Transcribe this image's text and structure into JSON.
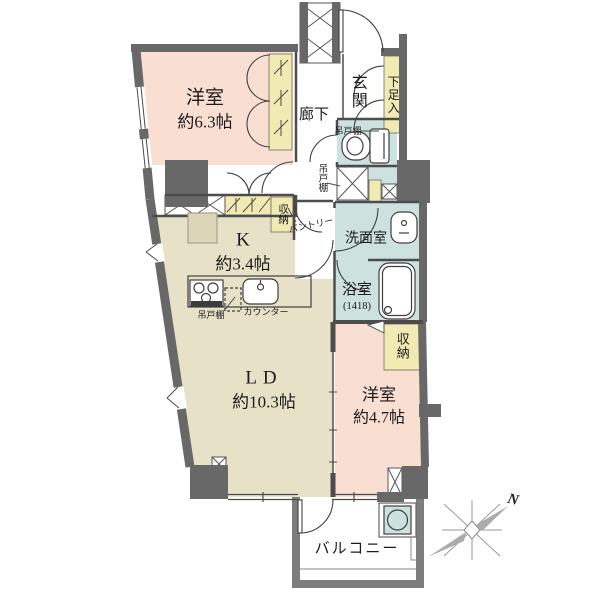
{
  "colors": {
    "wall": "#686868",
    "room_pink": "#f9ded2",
    "room_beige": "#e7e1c8",
    "room_wet_teal": "#cde2de",
    "storage_yellow": "#f1eab2",
    "balcony_wall": "#7d7d7d"
  },
  "rooms": {
    "bedroom_main": {
      "name": "洋室",
      "size": "約6.3帖"
    },
    "hallway": {
      "name": "廊下"
    },
    "entrance": {
      "name": "玄関"
    },
    "shoe_cabinet": {
      "name": "下足入"
    },
    "kitchen": {
      "name": "K",
      "size": "約3.4帖"
    },
    "washroom": {
      "name": "洗面室"
    },
    "bathroom": {
      "name": "浴室",
      "size": "(1418)"
    },
    "living_dining": {
      "name": "LD",
      "size": "約10.3帖"
    },
    "bedroom_second": {
      "name": "洋室",
      "size": "約4.7帖"
    },
    "balcony": {
      "name": "バルコニー"
    }
  },
  "storage": {
    "closet_bath_side": "収納",
    "closet_kitchen": "収納",
    "hanging_cupboard_toilet": "吊戸棚",
    "hanging_cupboard_hall": "吊戸棚",
    "hanging_cupboard_kitchen": "吊戸棚",
    "pantry": "パントリー",
    "counter": "カウンター"
  },
  "compass": {
    "north": "N"
  }
}
